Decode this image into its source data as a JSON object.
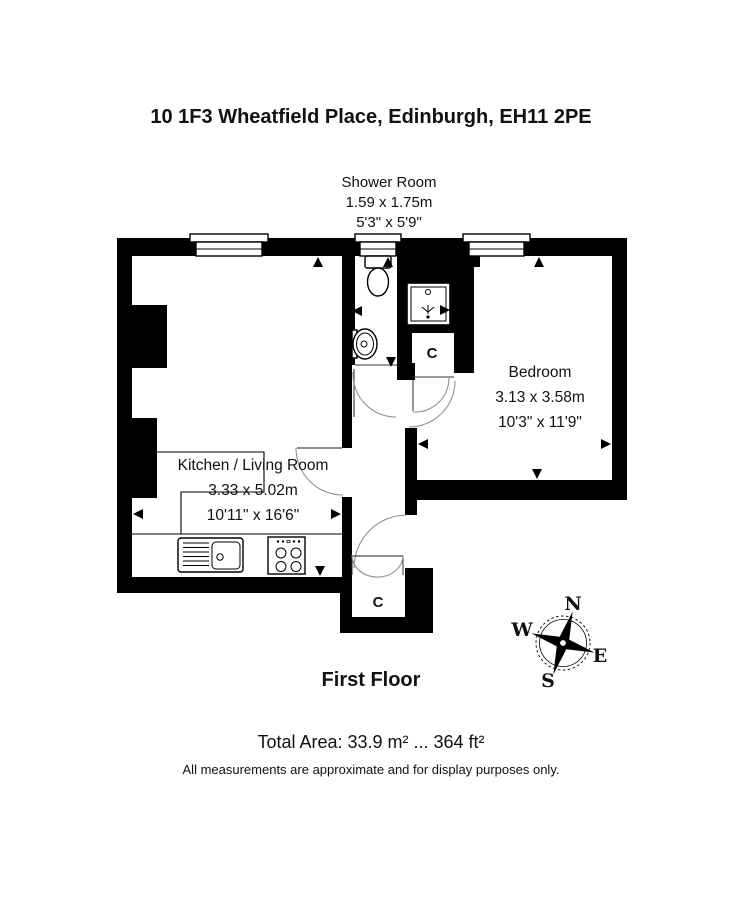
{
  "title": "10 1F3 Wheatfield Place, Edinburgh, EH11 2PE",
  "rooms": {
    "shower_room": {
      "name": "Shower Room",
      "dims_metric": "1.59 x 1.75m",
      "dims_imperial": "5'3\" x 5'9\""
    },
    "kitchen_living": {
      "name": "Kitchen / Living Room",
      "dims_metric": "3.33 x 5.02m",
      "dims_imperial": "10'11\" x 16'6\""
    },
    "bedroom": {
      "name": "Bedroom",
      "dims_metric": "3.13 x 3.58m",
      "dims_imperial": "10'3\" x 11'9\""
    },
    "cupboard_hall": {
      "label": "C"
    },
    "cupboard_entrance": {
      "label": "C"
    }
  },
  "floor_label": "First Floor",
  "total_area": "Total Area: 33.9 m² ... 364 ft²",
  "disclaimer": "All measurements are approximate and for display purposes only.",
  "compass": {
    "north": "N",
    "east": "E",
    "south": "S",
    "west": "W"
  },
  "colors": {
    "walls": "#000000",
    "background": "#ffffff",
    "door_arc": "#8f8f8f"
  }
}
